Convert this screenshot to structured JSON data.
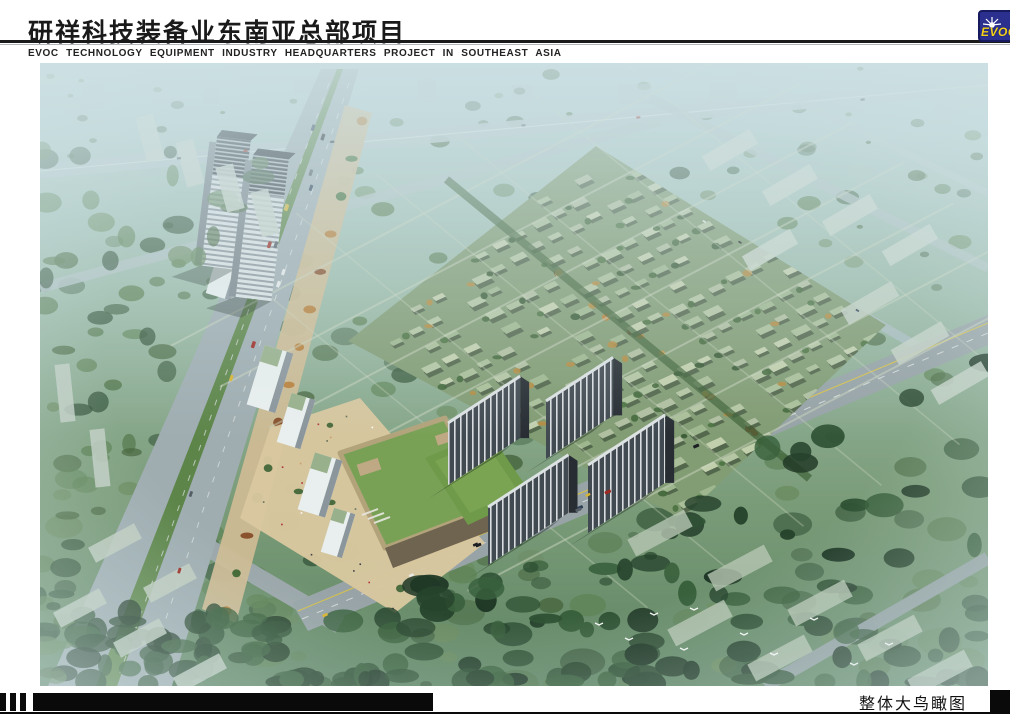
{
  "header": {
    "title": "研祥科技装备业东南亚总部项目",
    "subtitle": "EVOC TECHNOLOGY EQUIPMENT INDUSTRY HEADQUARTERS PROJECT IN SOUTHEAST ASIA",
    "logo": {
      "text": "EVOC",
      "icon": "sunburst-icon"
    }
  },
  "footer": {
    "caption": "整体大鸟瞰图"
  },
  "colors": {
    "page-bg": "#ffffff",
    "ink": "#1a1a1a",
    "logo-blue": "#2b2f8e",
    "logo-border": "#171a5e",
    "logo-yellow": "#f2d01c",
    "bar-black": "#0a0a0a",
    "haze": "#cfe2e4",
    "road": "#9fadb1",
    "median-green": "#5d8549",
    "villa-roof": "#aabf99",
    "plaza": "#d8c79f",
    "hall-roof": "#79a156",
    "lawn": "#6f9a49",
    "tower-dark": "#424a51",
    "tower-light": "#e7edee"
  }
}
